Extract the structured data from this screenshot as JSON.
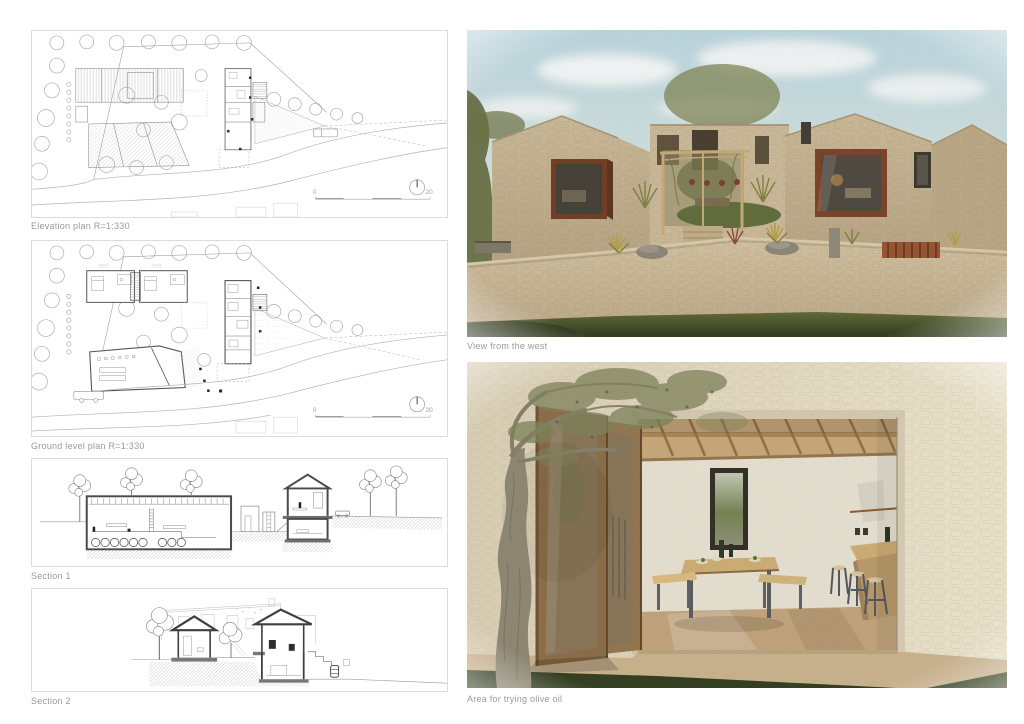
{
  "captions": {
    "elevation_plan": "Elevation plan R=1:330",
    "ground_plan": "Ground level plan R=1:330",
    "section_1": "Section 1",
    "section_2": "Section 2",
    "render_west": "View from the west",
    "render_olive": "Area for trying olive oil"
  },
  "plan_scale": {
    "start": "0",
    "end": "20"
  },
  "ground_plan_labels": {
    "bed_left": "bed",
    "bed_right": "bed"
  },
  "colors": {
    "paper": "#ffffff",
    "caption_text": "#9a9a9a",
    "plan_line": "#8f8f8f",
    "section_cut": "#3f3f3f",
    "sky": "#c4dde5",
    "stone": "#c8b394",
    "stone_wall": "#cfbd9c",
    "window_frame_rust": "#743d22",
    "pergola_wood": "#c9ab79",
    "grass_dark": "#2e3b1c",
    "door_wood": "#8a6b46",
    "floor_tan": "#c2a47c"
  }
}
